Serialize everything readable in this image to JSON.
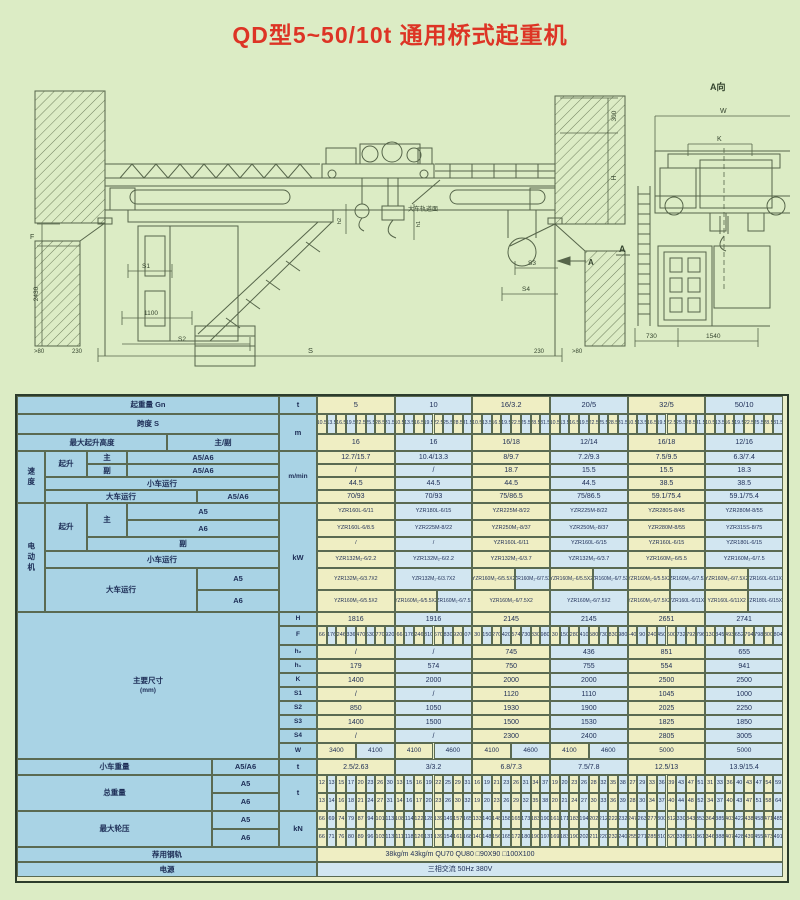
{
  "title": "QD型5~50/10t 通用桥式起重机",
  "drawing": {
    "side_view": {
      "rail_note": "大车轨道面",
      "section_arrow": "A",
      "dims": {
        "F": "F",
        "v2430": "2430",
        "S1": "S1",
        "v1100": "1100",
        "S2": "S2",
        "S3": "S3",
        "S4": "S4",
        "S": "S",
        "left_230": "230",
        "right_230": "230",
        "left_gt80": ">80",
        "right_gt80": ">80",
        "v300": "300",
        "H": "H",
        "h1": "h1",
        "h2": "h2"
      }
    },
    "end_view": {
      "view_label": "A向",
      "section_label": "A",
      "dims": {
        "W": "W",
        "K": "K",
        "v730": "730",
        "v1540": "1540"
      }
    }
  },
  "table": {
    "headers": {
      "capacity": "起重量 Gn",
      "capacity_unit": "t",
      "span": "跨度 S",
      "span_unit": "m",
      "lift_height": "最大起升高度",
      "lift_height_sub": "主/副",
      "speed": "速度",
      "speed_unit": "m/min",
      "motor": "电动机",
      "motor_unit": "kW",
      "hoist": "起升",
      "main": "主",
      "aux": "副",
      "a5a6": "A5/A6",
      "a5": "A5",
      "a6": "A6",
      "trolley_travel": "小车运行",
      "crane_travel": "大车运行",
      "dims": "主要尺寸",
      "dims_unit": "(mm)",
      "dim_rows": [
        "H",
        "F",
        "h₂",
        "h₁",
        "K",
        "S1",
        "S2",
        "S3",
        "S4",
        "W"
      ],
      "trolley_weight": "小车重量",
      "trolley_weight_unit": "t",
      "total_weight": "总重量",
      "total_weight_unit": "t",
      "max_wheel_load": "最大轮压",
      "max_wheel_load_unit": "kN",
      "rail": "荐用钢轨",
      "power": "电源"
    },
    "spans": [
      "10.5",
      "13.5",
      "16.5",
      "19.5",
      "22.5",
      "25.5",
      "28.5",
      "31.5"
    ],
    "rail_value": "38kg/m  43kg/m  QU70  QU80  □90X90  □100X100",
    "power_value": "三相交流  50Hz  380V",
    "groups": [
      {
        "capacity": "5",
        "lift": "16",
        "v_main": "12.7/15.7",
        "v_aux": "/",
        "v_trolley": "44.5",
        "v_crane": "70/93",
        "m_main_a5": "YZR160L-6/11",
        "m_main_a6": "YZR160L-6/8.5",
        "m_aux": "/",
        "m_trolley": "YZR132M₂-6/2.2",
        "m_crane_a5": [
          "YZR132M₂-6/3.7X2"
        ],
        "m_crane_a6": [
          "YZR160M₂-6/5.5X2"
        ],
        "H": "1816",
        "F": [
          "66",
          "176",
          "246",
          "336",
          "470",
          "630",
          "770",
          "920"
        ],
        "h2": "/",
        "h1": "179",
        "K": "1400",
        "S1": "/",
        "S2": "850",
        "S3": "1400",
        "S4": "/",
        "W": [
          "3400",
          "4100"
        ],
        "tw": "2.5/2.63",
        "gw_a5": [
          "12",
          "13",
          "15",
          "17",
          "20",
          "23",
          "26",
          "30"
        ],
        "gw_a6": [
          "13",
          "14",
          "16",
          "18",
          "21",
          "24",
          "27",
          "31"
        ],
        "wl_a5": [
          "66",
          "69",
          "74",
          "79",
          "87",
          "94",
          "101",
          "113"
        ],
        "wl_a6": [
          "66",
          "71",
          "76",
          "80",
          "89",
          "96",
          "103",
          "113"
        ]
      },
      {
        "capacity": "10",
        "lift": "16",
        "v_main": "10.4/13.3",
        "v_aux": "/",
        "v_trolley": "44.5",
        "v_crane": "70/93",
        "m_main_a5": "YZR180L-6/15",
        "m_main_a6": "YZR225M-8/22",
        "m_aux": "/",
        "m_trolley": "YZR132M₂-6/2.2",
        "m_crane_a5": [
          "YZR132M₂-6/3.7X2"
        ],
        "m_crane_a6": [
          "YZR160M₂-6/5.5X2",
          "YZR160M₂-6/7.5X2"
        ],
        "H": "1916",
        "F": [
          "66",
          "176",
          "246",
          "310",
          "670",
          "830",
          "920",
          "1070"
        ],
        "h2": "/",
        "h1": "574",
        "K": "2000",
        "S1": "/",
        "S2": "1050",
        "S3": "1500",
        "S4": "/",
        "W": [
          "4100",
          "4600"
        ],
        "tw": "3/3.2",
        "gw_a5": [
          "13",
          "15",
          "16",
          "19",
          "22",
          "25",
          "29",
          "31"
        ],
        "gw_a6": [
          "14",
          "16",
          "17",
          "20",
          "23",
          "26",
          "30",
          "32"
        ],
        "wl_a5": [
          "108",
          "114",
          "122",
          "128",
          "139",
          "149",
          "157",
          "165"
        ],
        "wl_a6": [
          "111",
          "118",
          "126",
          "131",
          "139",
          "154",
          "161",
          "168"
        ]
      },
      {
        "capacity": "16/3.2",
        "lift": "16/18",
        "v_main": "8/9.7",
        "v_aux": "18.7",
        "v_trolley": "44.5",
        "v_crane": "75/86.5",
        "m_main_a5": "YZR225M-8/22",
        "m_main_a6": "YZR250M₁-8/37",
        "m_aux": "YZR160L-6/11",
        "m_trolley": "YZR132M₂-6/3.7",
        "m_crane_a5": [
          "YZR160M₂-6/5.5X2",
          "YZR160M₂-6/7.5X2"
        ],
        "m_crane_a6": [
          "YZR160M₂-6/7.5X2"
        ],
        "H": "2145",
        "F": [
          "30",
          "150",
          "270",
          "420",
          "574",
          "730",
          "830",
          "980"
        ],
        "h2": "745",
        "h1": "750",
        "K": "2000",
        "S1": "1120",
        "S2": "1930",
        "S3": "1500",
        "S4": "2300",
        "W": [
          "4100",
          "4600"
        ],
        "tw": "6.8/7.3",
        "gw_a5": [
          "16",
          "19",
          "21",
          "23",
          "26",
          "31",
          "34",
          "37"
        ],
        "gw_a6": [
          "19",
          "20",
          "23",
          "26",
          "29",
          "32",
          "35",
          "38"
        ],
        "wl_a5": [
          "133",
          "140",
          "148",
          "158",
          "165",
          "173",
          "183",
          "190"
        ],
        "wl_a6": [
          "140",
          "148",
          "156",
          "165",
          "172",
          "180",
          "190",
          "197"
        ]
      },
      {
        "capacity": "20/5",
        "lift": "12/14",
        "v_main": "7.2/9.3",
        "v_aux": "15.5",
        "v_trolley": "44.5",
        "v_crane": "75/86.5",
        "m_main_a5": "YZR225M-8/22",
        "m_main_a6": "YZR250M₁-8/37",
        "m_aux": "YZR160L-6/15",
        "m_trolley": "YZR132M₂-6/3.7",
        "m_crane_a5": [
          "YZR160M₂-6/5.5X2",
          "YZR160M₂-6/7.5X2"
        ],
        "m_crane_a6": [
          "YZR160M₂-6/7.5X2"
        ],
        "H": "2145",
        "F": [
          "30",
          "150",
          "280",
          "410",
          "580",
          "730",
          "830",
          "980"
        ],
        "h2": "436",
        "h1": "755",
        "K": "2000",
        "S1": "1110",
        "S2": "1900",
        "S3": "1530",
        "S4": "2400",
        "W": [
          "4100",
          "4600"
        ],
        "tw": "7.5/7.8",
        "gw_a5": [
          "19",
          "20",
          "23",
          "26",
          "28",
          "32",
          "35",
          "38"
        ],
        "gw_a6": [
          "20",
          "21",
          "24",
          "27",
          "30",
          "33",
          "36",
          "39"
        ],
        "wl_a5": [
          "161",
          "171",
          "183",
          "194",
          "202",
          "212",
          "222",
          "232"
        ],
        "wl_a6": [
          "169",
          "183",
          "190",
          "202",
          "211",
          "220",
          "232",
          "240"
        ]
      },
      {
        "capacity": "32/5",
        "lift": "16/18",
        "v_main": "7.5/9.5",
        "v_aux": "15.5",
        "v_trolley": "38.5",
        "v_crane": "59.1/75.4",
        "m_main_a5": "YZR280S-8/45",
        "m_main_a6": "YZR280M-8/55",
        "m_aux": "YZR160L-6/15",
        "m_trolley": "YZR160M₂-6/5.5",
        "m_crane_a5": [
          "YZR160M₂-6/5.5X2",
          "YZR160M₂-6/7.5X2"
        ],
        "m_crane_a6": [
          "YZR160M₂-6/7.5X2",
          "YZR160L-6/11X2"
        ],
        "H": "2651",
        "F": [
          "-40",
          "90",
          "240",
          "450",
          "600",
          "732",
          "792",
          "796"
        ],
        "h2": "851",
        "h1": "554",
        "K": "2500",
        "S1": "1045",
        "S2": "2025",
        "S3": "1825",
        "S4": "2805",
        "W": [
          "5000"
        ],
        "tw": "12.5/13",
        "gw_a5": [
          "27",
          "29",
          "33",
          "36",
          "39",
          "43",
          "47",
          "51"
        ],
        "gw_a6": [
          "28",
          "30",
          "34",
          "37",
          "40",
          "44",
          "48",
          "52"
        ],
        "wl_a5": [
          "247",
          "263",
          "277",
          "300",
          "312",
          "330",
          "343",
          "353"
        ],
        "wl_a6": [
          "255",
          "271",
          "285",
          "310",
          "320",
          "338",
          "351",
          "361"
        ]
      },
      {
        "capacity": "50/10",
        "lift": "12/16",
        "v_main": "6.3/7.4",
        "v_aux": "18.3",
        "v_trolley": "38.5",
        "v_crane": "59.1/75.4",
        "m_main_a5": "YZR280M-8/55",
        "m_main_a6": "YZR315S-8/75",
        "m_aux": "YZR180L-6/15",
        "m_trolley": "YZR160M₂-6/7.5",
        "m_crane_a5": [
          "YZR160M₂-6/7.5X2",
          "YZR160L-6/11X2"
        ],
        "m_crane_a6": [
          "YZR160L-6/11X2",
          "YZR180L-6/15X2"
        ],
        "H": "2741",
        "F": [
          "130",
          "345",
          "493",
          "652",
          "794",
          "798",
          "800",
          "804"
        ],
        "h2": "655",
        "h1": "941",
        "K": "2500",
        "S1": "1000",
        "S2": "2250",
        "S3": "1850",
        "S4": "3005",
        "W": [
          "5000"
        ],
        "tw": "13.9/15.4",
        "gw_a5": [
          "31",
          "33",
          "36",
          "40",
          "43",
          "47",
          "54",
          "59"
        ],
        "gw_a6": [
          "34",
          "37",
          "40",
          "43",
          "47",
          "51",
          "58",
          "64"
        ],
        "wl_a5": [
          "364",
          "385",
          "403",
          "422",
          "438",
          "458",
          "471",
          "485"
        ],
        "wl_a6": [
          "346",
          "388",
          "407",
          "428",
          "439",
          "455",
          "473",
          "491"
        ]
      }
    ]
  }
}
